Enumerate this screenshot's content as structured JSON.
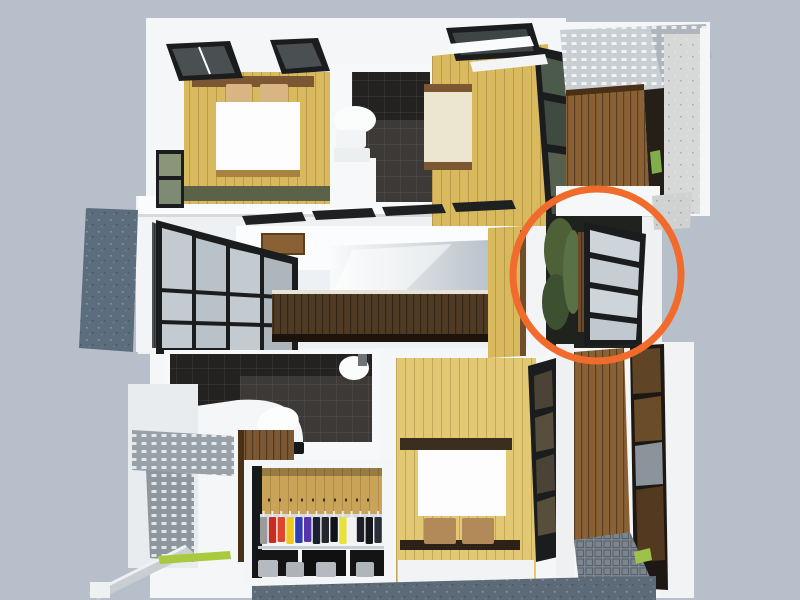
{
  "meta": {
    "kind": "3d-floorplan-render",
    "width": 800,
    "height": 600
  },
  "colors": {
    "background": "#b7c0ca",
    "wall_white": "#f4f6f7",
    "wall_shade": "#e4e8eb",
    "wood_floor": "#d8b95e",
    "wood_floor_light": "#e2c873",
    "wood_wall": "#c9a458",
    "wood_dark": "#7b5833",
    "counter_brown": "#4f3a24",
    "deck_brown": "#8a6134",
    "tile_dark": "#3c3937",
    "tile_wall_dark": "#242220",
    "glass_pane": "#c3cbd1",
    "frame_black": "#1b1c1d",
    "plant_green": "#4e6038",
    "grass_green": "#a9c93e",
    "concrete_blue": "#5c6d7e",
    "pavement_blue": "#5d6b79",
    "concrete_light": "#d7d9d8",
    "canopy_gray": "#c9ced3",
    "perforated_gray": "#99a1a8",
    "bed_white": "#fdfdfd",
    "duvet_cream": "#ece5cf",
    "pillow_tan": "#d9b584",
    "pillow_brown": "#b28a5a",
    "accent_annotation": "#f06b2c"
  },
  "annotation": {
    "shape": "ellipse",
    "cx": 597,
    "cy": 275,
    "rx": 84,
    "ry": 86,
    "stroke_width": 7,
    "color": "#f06b2c",
    "target": "courtyard-glass-wall"
  },
  "closet": {
    "clothes_colors": [
      "#9b9b9b",
      "#c92b20",
      "#e0442a",
      "#efc81f",
      "#2e3db8",
      "#5633a8",
      "#1b2030",
      "#23272e",
      "#111318",
      "#e8e13a",
      "#f2f2f2",
      "#1c1f28",
      "#14161c",
      "#2a2e38"
    ]
  },
  "scene": {
    "rooms": [
      "bedroom-top-left",
      "bathroom-top",
      "bedroom-top-middle",
      "balcony-top-right",
      "living-area",
      "courtyard",
      "bathroom-bottom",
      "walk-in-closet",
      "bedroom-bottom",
      "entry-corridor"
    ]
  }
}
